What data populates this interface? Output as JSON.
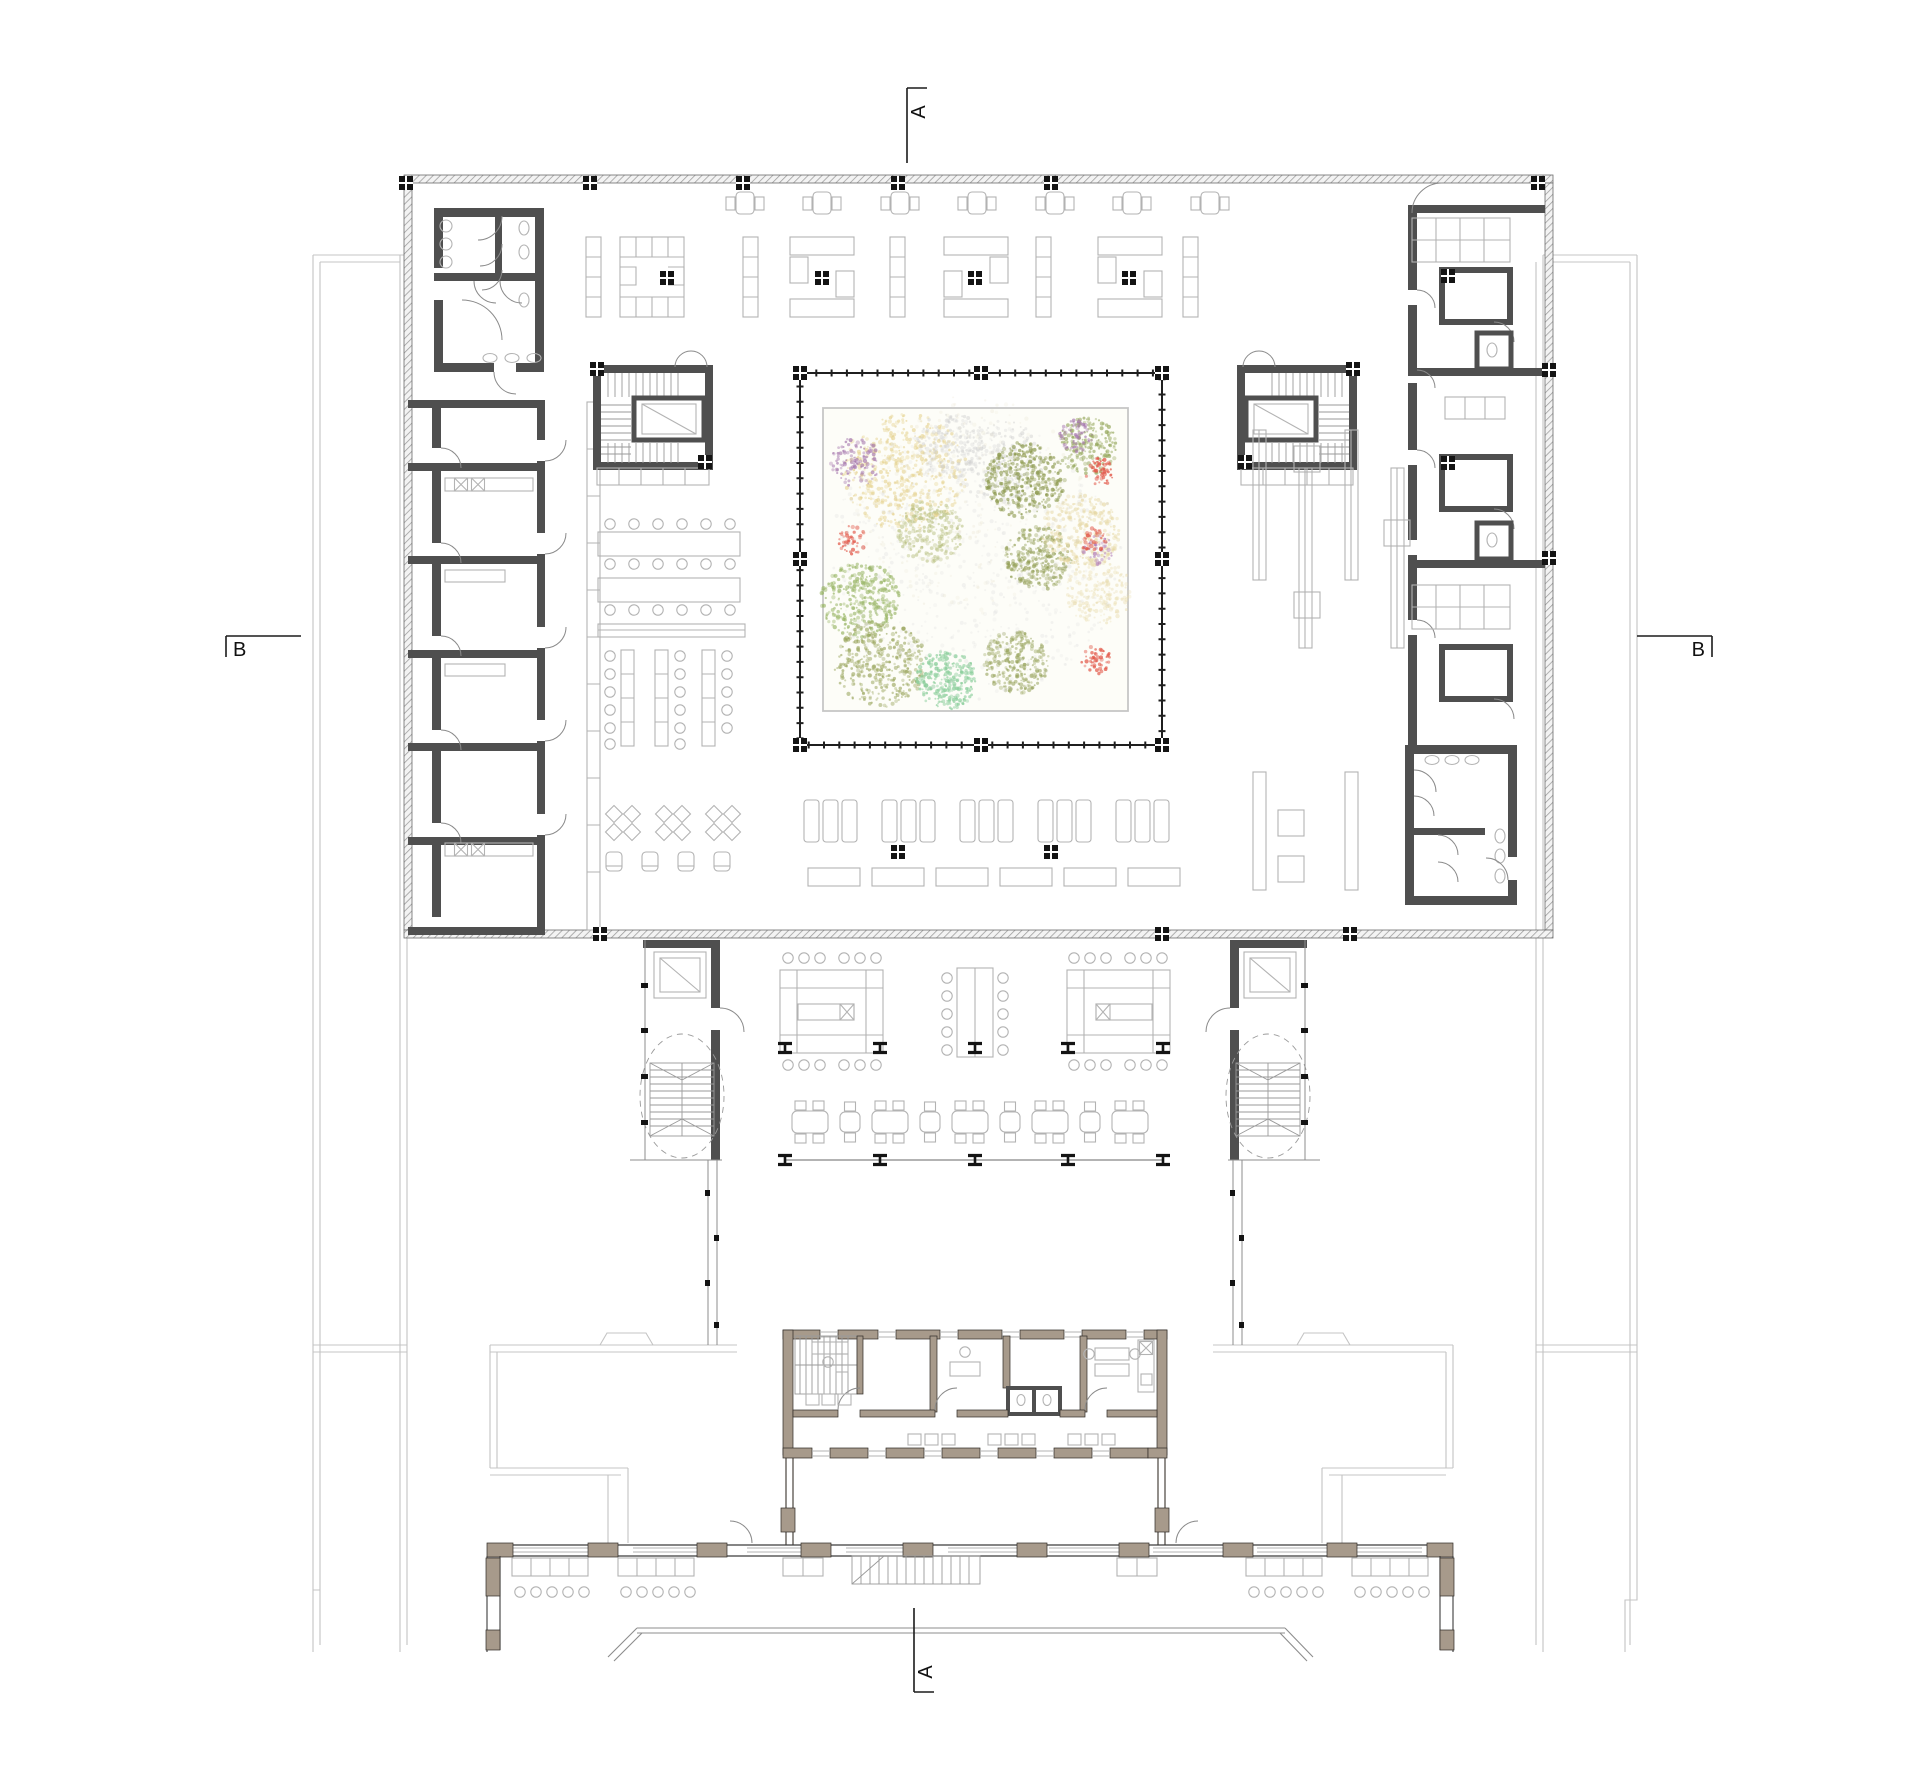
{
  "title": "library-floor-plan",
  "section_markers": {
    "top": "A",
    "bottom": "A",
    "left": "B",
    "right": "B"
  },
  "colors": {
    "wall_dark": "#4f4f4f",
    "wall_annex": "#a79a8b",
    "context_line": "#c4c4c4",
    "furniture_line": "#b3b3b3",
    "marker": "#1c1c1c",
    "garden_frame": "#c6c6c6"
  },
  "garden": {
    "frame": {
      "x": 823,
      "y": 408,
      "w": 305,
      "h": 303
    },
    "clusters": [
      {
        "cx": 905,
        "cy": 472,
        "r": 62,
        "color": "#e6d391",
        "n": 520,
        "o": 0.65
      },
      {
        "cx": 856,
        "cy": 462,
        "r": 26,
        "color": "#a678ae",
        "n": 110,
        "o": 0.7
      },
      {
        "cx": 950,
        "cy": 445,
        "r": 34,
        "color": "#d2d2d2",
        "n": 170,
        "o": 0.5
      },
      {
        "cx": 1000,
        "cy": 462,
        "r": 44,
        "color": "#cfcfcf",
        "n": 230,
        "o": 0.5
      },
      {
        "cx": 1025,
        "cy": 480,
        "r": 40,
        "color": "#8e9b51",
        "n": 380,
        "o": 0.72
      },
      {
        "cx": 1038,
        "cy": 558,
        "r": 34,
        "color": "#939f56",
        "n": 280,
        "o": 0.68
      },
      {
        "cx": 1088,
        "cy": 446,
        "r": 30,
        "color": "#95a75c",
        "n": 200,
        "o": 0.68
      },
      {
        "cx": 1076,
        "cy": 436,
        "r": 17,
        "color": "#a678ae",
        "n": 60,
        "o": 0.7
      },
      {
        "cx": 1100,
        "cy": 472,
        "r": 15,
        "color": "#e25748",
        "n": 55,
        "o": 0.8
      },
      {
        "cx": 1082,
        "cy": 532,
        "r": 40,
        "color": "#e6d7a2",
        "n": 300,
        "o": 0.6
      },
      {
        "cx": 1098,
        "cy": 550,
        "r": 15,
        "color": "#b07ab8",
        "n": 40,
        "o": 0.7
      },
      {
        "cx": 1093,
        "cy": 540,
        "r": 13,
        "color": "#e25748",
        "n": 35,
        "o": 0.75
      },
      {
        "cx": 851,
        "cy": 540,
        "r": 15,
        "color": "#e25748",
        "n": 48,
        "o": 0.75
      },
      {
        "cx": 930,
        "cy": 532,
        "r": 33,
        "color": "#b8c081",
        "n": 230,
        "o": 0.6
      },
      {
        "cx": 860,
        "cy": 600,
        "r": 40,
        "color": "#9bb769",
        "n": 330,
        "o": 0.7
      },
      {
        "cx": 880,
        "cy": 664,
        "r": 46,
        "color": "#96a257",
        "n": 360,
        "o": 0.62
      },
      {
        "cx": 946,
        "cy": 680,
        "r": 31,
        "color": "#8dcf9d",
        "n": 250,
        "o": 0.78
      },
      {
        "cx": 1016,
        "cy": 662,
        "r": 33,
        "color": "#98a45d",
        "n": 270,
        "o": 0.62
      },
      {
        "cx": 1096,
        "cy": 660,
        "r": 15,
        "color": "#e25748",
        "n": 48,
        "o": 0.78
      },
      {
        "cx": 1098,
        "cy": 592,
        "r": 34,
        "color": "#e9dcae",
        "n": 200,
        "o": 0.5
      },
      {
        "cx": 975,
        "cy": 560,
        "r": 148,
        "color": "#d9d9d9",
        "n": 650,
        "o": 0.3
      },
      {
        "cx": 972,
        "cy": 505,
        "r": 115,
        "color": "#e8e2cc",
        "n": 280,
        "o": 0.3
      }
    ]
  }
}
